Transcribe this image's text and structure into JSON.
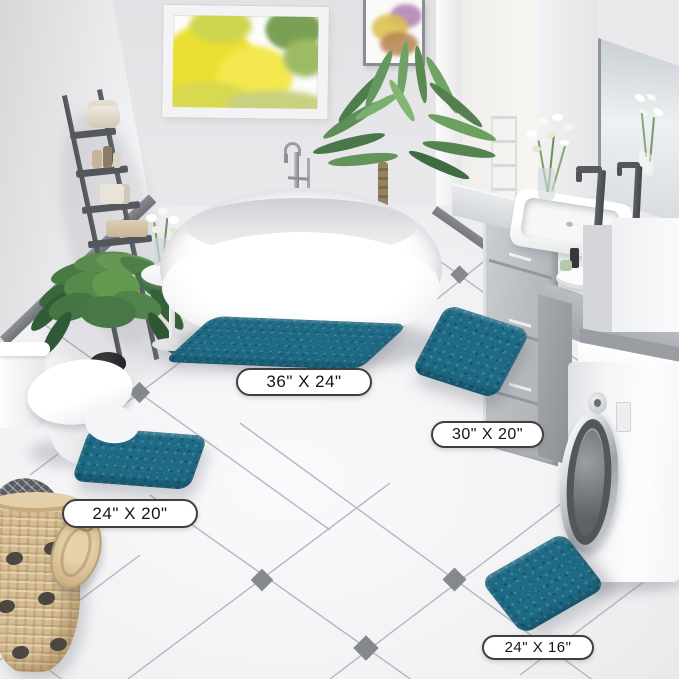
{
  "scene": {
    "setting": "bathroom product photo",
    "items_visible": [
      "bathtub",
      "toilet",
      "washing machine",
      "vanity with sinks",
      "ladder shelf",
      "potted plants",
      "laundry basket",
      "window",
      "wall art",
      "teal bath rug set"
    ]
  },
  "colors": {
    "rug_teal": "#1e6a85",
    "floor_tile": "#f3f3f5",
    "wall": "#e8e8eb",
    "diamond_accent": "#85888e"
  },
  "labels": {
    "rug_36x24": "36\" X 24\"",
    "rug_30x20": "30\" X 20\"",
    "rug_24x20": "24\" X 20\"",
    "rug_24x16": "24\" X 16\""
  }
}
